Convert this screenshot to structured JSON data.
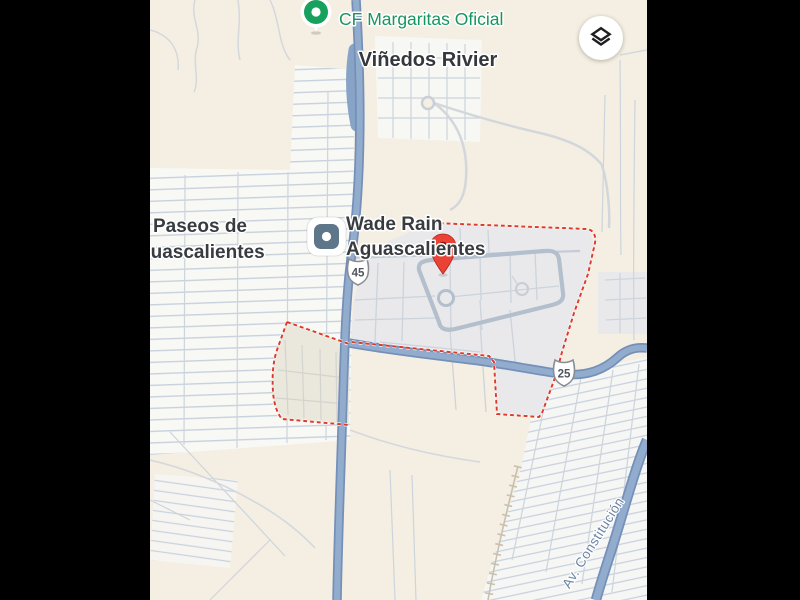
{
  "window": {
    "letterbox_color": "#000000"
  },
  "map": {
    "kind": "google-maps-mobile-view",
    "background": "#f4efe2"
  },
  "labels": {
    "green_poi": {
      "text": "CF Margaritas Oficial",
      "color": "#18955f"
    },
    "locality": {
      "text": "Viñedos Rivier",
      "color": "#34383c"
    },
    "neighborhood": {
      "line1": "Paseos de",
      "line2": "Aguascalientes",
      "color": "#383c40"
    },
    "business": {
      "line1": "Wade Rain",
      "line2": "Aguascalientes",
      "color": "#383c40"
    },
    "road": {
      "text": "Av. Constitución",
      "color": "#6b83a3"
    }
  },
  "route_shields": [
    {
      "number": "45"
    },
    {
      "number": "25"
    }
  ],
  "markers": {
    "destination_pin": {
      "color": "#ea4335",
      "inner_color": "#8a150e"
    },
    "green_pin": {
      "color": "#17a05e"
    }
  },
  "boundary": {
    "color": "#dc3a2c",
    "style": "dashed"
  },
  "controls": {
    "layers_button": {
      "icon": "layers",
      "icon_color": "#1f1f1f",
      "bg": "#ffffff"
    }
  }
}
